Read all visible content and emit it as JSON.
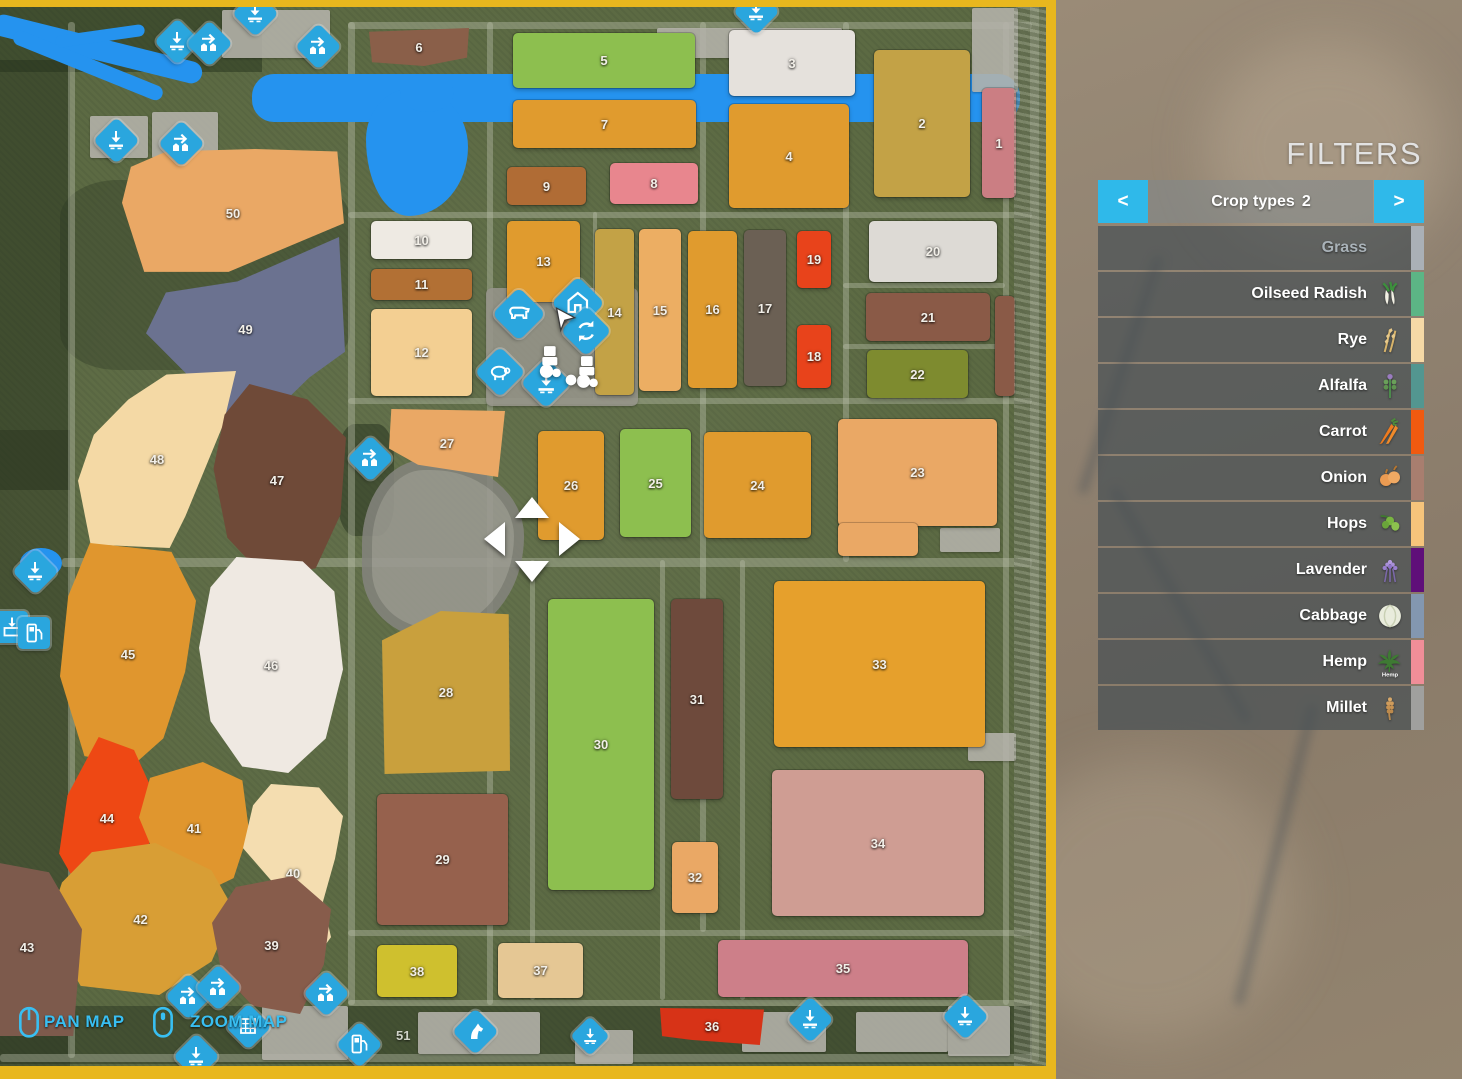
{
  "filters": {
    "title": "FILTERS",
    "header": {
      "label": "Crop types",
      "count": "2",
      "prev": "<",
      "next": ">"
    },
    "items": [
      {
        "label": "Grass",
        "icon": "",
        "color": "#aab0b6",
        "disabled": true
      },
      {
        "label": "Oilseed Radish",
        "icon": "oilseed-radish",
        "color": "#5cb585",
        "disabled": false
      },
      {
        "label": "Rye",
        "icon": "rye",
        "color": "#f6d9a6",
        "disabled": false
      },
      {
        "label": "Alfalfa",
        "icon": "alfalfa",
        "color": "#539690",
        "disabled": false
      },
      {
        "label": "Carrot",
        "icon": "carrot",
        "color": "#f05a10",
        "disabled": false
      },
      {
        "label": "Onion",
        "icon": "onion",
        "color": "#a87e6f",
        "disabled": false
      },
      {
        "label": "Hops",
        "icon": "hops",
        "color": "#f6c47b",
        "disabled": false
      },
      {
        "label": "Lavender",
        "icon": "lavender",
        "color": "#5f0f79",
        "disabled": false
      },
      {
        "label": "Cabbage",
        "icon": "cabbage",
        "color": "#8397b0",
        "disabled": false
      },
      {
        "label": "Hemp",
        "icon": "hemp",
        "color": "#f08e98",
        "disabled": false
      },
      {
        "label": "Millet",
        "icon": "millet",
        "color": "#a0a09e",
        "disabled": false
      }
    ]
  },
  "map": {
    "pan_label": "PAN MAP",
    "zoom_label": "ZOOM MAP",
    "extra_label": "51",
    "fields": [
      {
        "id": "6",
        "x": 369,
        "y": 28,
        "w": 100,
        "h": 38,
        "c": "#8a5f49",
        "poly": "0% 10%,100% 0%,98% 78%,55% 100%,3% 90%"
      },
      {
        "id": "5",
        "x": 513,
        "y": 33,
        "w": 182,
        "h": 55,
        "c": "#8dbf4f"
      },
      {
        "id": "3",
        "x": 729,
        "y": 30,
        "w": 126,
        "h": 66,
        "c": "#e5e1dc"
      },
      {
        "id": "2",
        "x": 874,
        "y": 50,
        "w": 96,
        "h": 147,
        "c": "#c3a246"
      },
      {
        "id": "1",
        "x": 982,
        "y": 88,
        "w": 34,
        "h": 110,
        "c": "#cb7e83"
      },
      {
        "id": "7",
        "x": 513,
        "y": 100,
        "w": 183,
        "h": 48,
        "c": "#e09b2e"
      },
      {
        "id": "4",
        "x": 729,
        "y": 104,
        "w": 120,
        "h": 104,
        "c": "#e09b2e"
      },
      {
        "id": "9",
        "x": 507,
        "y": 167,
        "w": 79,
        "h": 38,
        "c": "#b06c35"
      },
      {
        "id": "8",
        "x": 610,
        "y": 163,
        "w": 88,
        "h": 41,
        "c": "#e8868e"
      },
      {
        "id": "10",
        "x": 371,
        "y": 221,
        "w": 101,
        "h": 38,
        "c": "#eeeae3"
      },
      {
        "id": "11",
        "x": 371,
        "y": 269,
        "w": 101,
        "h": 31,
        "c": "#b27034"
      },
      {
        "id": "13",
        "x": 507,
        "y": 221,
        "w": 73,
        "h": 81,
        "c": "#e09b2e"
      },
      {
        "id": "12",
        "x": 371,
        "y": 309,
        "w": 101,
        "h": 87,
        "c": "#f3cf92"
      },
      {
        "id": "14",
        "x": 595,
        "y": 229,
        "w": 39,
        "h": 166,
        "c": "#c3a246"
      },
      {
        "id": "15",
        "x": 639,
        "y": 229,
        "w": 42,
        "h": 162,
        "c": "#ecae63"
      },
      {
        "id": "16",
        "x": 688,
        "y": 231,
        "w": 49,
        "h": 157,
        "c": "#e09b2e"
      },
      {
        "id": "17",
        "x": 744,
        "y": 230,
        "w": 42,
        "h": 156,
        "c": "#6b6054"
      },
      {
        "id": "19",
        "x": 797,
        "y": 231,
        "w": 34,
        "h": 57,
        "c": "#e8431b"
      },
      {
        "id": "18",
        "x": 797,
        "y": 325,
        "w": 34,
        "h": 63,
        "c": "#e8431b"
      },
      {
        "id": "20",
        "x": 869,
        "y": 221,
        "w": 128,
        "h": 61,
        "c": "#dddad5"
      },
      {
        "id": "21",
        "x": 866,
        "y": 293,
        "w": 124,
        "h": 48,
        "c": "#8a5a47"
      },
      {
        "id": "",
        "x": 995,
        "y": 296,
        "w": 20,
        "h": 100,
        "c": "#8a5a47"
      },
      {
        "id": "22",
        "x": 867,
        "y": 350,
        "w": 101,
        "h": 48,
        "c": "#7e8b2f"
      },
      {
        "id": "27",
        "x": 389,
        "y": 409,
        "w": 116,
        "h": 68,
        "c": "#eaa865",
        "poly": "2% 0%,100% 3%,94% 100%,25% 82%,0% 58%"
      },
      {
        "id": "26",
        "x": 538,
        "y": 431,
        "w": 66,
        "h": 109,
        "c": "#e09b2e"
      },
      {
        "id": "25",
        "x": 620,
        "y": 429,
        "w": 71,
        "h": 108,
        "c": "#8dbf4f"
      },
      {
        "id": "24",
        "x": 704,
        "y": 432,
        "w": 107,
        "h": 106,
        "c": "#e09b2e"
      },
      {
        "id": "23",
        "x": 838,
        "y": 419,
        "w": 159,
        "h": 107,
        "c": "#eaa865"
      },
      {
        "id": "",
        "x": 838,
        "y": 523,
        "w": 80,
        "h": 33,
        "c": "#eaa865"
      },
      {
        "id": "33",
        "x": 774,
        "y": 581,
        "w": 211,
        "h": 166,
        "c": "#e6a02c"
      },
      {
        "id": "34",
        "x": 772,
        "y": 770,
        "w": 212,
        "h": 146,
        "c": "#cf9d93"
      },
      {
        "id": "28",
        "x": 382,
        "y": 611,
        "w": 128,
        "h": 163,
        "c": "#c9a03d",
        "poly": "0% 18%,46% 0%,99% 2%,100% 98%,2% 100%"
      },
      {
        "id": "29",
        "x": 377,
        "y": 794,
        "w": 131,
        "h": 131,
        "c": "#96614d"
      },
      {
        "id": "30",
        "x": 548,
        "y": 599,
        "w": 106,
        "h": 291,
        "c": "#8dbf4f"
      },
      {
        "id": "31",
        "x": 671,
        "y": 599,
        "w": 52,
        "h": 200,
        "c": "#6e4a3c"
      },
      {
        "id": "32",
        "x": 672,
        "y": 842,
        "w": 46,
        "h": 71,
        "c": "#eaa865"
      },
      {
        "id": "38",
        "x": 377,
        "y": 945,
        "w": 80,
        "h": 52,
        "c": "#cfc02e"
      },
      {
        "id": "37",
        "x": 498,
        "y": 943,
        "w": 85,
        "h": 55,
        "c": "#e5c794"
      },
      {
        "id": "35",
        "x": 718,
        "y": 940,
        "w": 250,
        "h": 57,
        "c": "#cd7f89"
      },
      {
        "id": "36",
        "x": 660,
        "y": 1008,
        "w": 104,
        "h": 37,
        "c": "#d73317",
        "poly": "0% 0%,100% 4%,96% 100%,30% 86%,2% 76%"
      },
      {
        "id": "50",
        "x": 122,
        "y": 149,
        "w": 222,
        "h": 128,
        "c": "#eaa865",
        "poly": "4% 14%,20% 2%,60% 0%,97% 2%,100% 58%,78% 74%,48% 96%,10% 96%,0% 42%"
      },
      {
        "id": "49",
        "x": 146,
        "y": 237,
        "w": 199,
        "h": 185,
        "c": "#6b7290",
        "poly": "46% 24%,97% 0%,100% 62%,82% 76%,62% 97%,42% 100%,24% 78%,0% 52%,10% 30%"
      },
      {
        "id": "48",
        "x": 78,
        "y": 371,
        "w": 158,
        "h": 177,
        "c": "#f4d9a5",
        "poly": "56% 2%,100% 0%,92% 30%,80% 56%,68% 82%,58% 100%,8% 98%,0% 62%,10% 36%,32% 16%"
      },
      {
        "id": "47",
        "x": 208,
        "y": 384,
        "w": 138,
        "h": 192,
        "c": "#6f4a38",
        "poly": "30% 0%,72% 8%,100% 28%,96% 68%,78% 96%,40% 100%,14% 80%,4% 44%,12% 16%"
      },
      {
        "id": "45",
        "x": 60,
        "y": 543,
        "w": 136,
        "h": 222,
        "c": "#e0962e",
        "poly": "22% 0%,82% 4%,100% 26%,92% 58%,76% 88%,54% 100%,18% 96%,0% 60%,6% 24%"
      },
      {
        "id": "46",
        "x": 199,
        "y": 557,
        "w": 144,
        "h": 216,
        "c": "#efe9e2",
        "poly": "26% 0%,72% 2%,94% 16%,100% 52%,88% 84%,62% 100%,30% 97%,8% 76%,0% 42%,8% 14%"
      },
      {
        "id": "44",
        "x": 55,
        "y": 737,
        "w": 104,
        "h": 162,
        "c": "#ee4814",
        "poly": "42% 0%,76% 8%,100% 42%,88% 72%,62% 100%,26% 97%,4% 72%,12% 36%"
      },
      {
        "id": "41",
        "x": 139,
        "y": 762,
        "w": 110,
        "h": 132,
        "c": "#e0962e",
        "poly": "10% 12%,58% 0%,94% 14%,100% 52%,86% 88%,56% 100%,20% 82%,0% 42%"
      },
      {
        "id": "40",
        "x": 243,
        "y": 784,
        "w": 100,
        "h": 178,
        "c": "#f4ddb0",
        "poly": "28% 0%,76% 2%,100% 18%,92% 42%,80% 66%,88% 86%,70% 100%,48% 86%,34% 58%,0% 36%,10% 12%"
      },
      {
        "id": "42",
        "x": 47,
        "y": 843,
        "w": 187,
        "h": 152,
        "c": "#d89e35",
        "poly": "24% 6%,58% 0%,88% 18%,100% 44%,88% 78%,60% 100%,18% 94%,0% 56%,8% 26%"
      },
      {
        "id": "39",
        "x": 212,
        "y": 876,
        "w": 119,
        "h": 138,
        "c": "#875c4b",
        "poly": "20% 8%,68% 0%,100% 24%,94% 64%,74% 100%,34% 94%,8% 70%,0% 34%"
      },
      {
        "id": "43",
        "x": -28,
        "y": 858,
        "w": 110,
        "h": 178,
        "c": "#7d5a4c",
        "poly": "0% 0%,70% 8%,100% 40%,92% 100%,0% 100%"
      }
    ],
    "pois": [
      {
        "t": "download",
        "x": 255,
        "y": 13
      },
      {
        "t": "download",
        "x": 177,
        "y": 41
      },
      {
        "t": "sell",
        "x": 209,
        "y": 43
      },
      {
        "t": "sell",
        "x": 318,
        "y": 46
      },
      {
        "t": "download",
        "x": 756,
        "y": 11
      },
      {
        "t": "download",
        "x": 116,
        "y": 140
      },
      {
        "t": "sell",
        "x": 181,
        "y": 143
      },
      {
        "t": "sell",
        "x": 370,
        "y": 458
      },
      {
        "t": "cow",
        "x": 519,
        "y": 314,
        "s": 46
      },
      {
        "t": "house",
        "x": 578,
        "y": 303,
        "s": 46
      },
      {
        "t": "loop",
        "x": 586,
        "y": 331,
        "s": 44
      },
      {
        "t": "sheep",
        "x": 500,
        "y": 372,
        "s": 44
      },
      {
        "t": "download",
        "x": 546,
        "y": 383,
        "s": 44
      },
      {
        "t": "download",
        "x": 35,
        "y": 571
      },
      {
        "t": "container",
        "x": 12,
        "y": 627,
        "v": "square"
      },
      {
        "t": "fuel",
        "x": 34,
        "y": 633,
        "v": "square"
      },
      {
        "t": "sell",
        "x": 188,
        "y": 996
      },
      {
        "t": "sell",
        "x": 218,
        "y": 987
      },
      {
        "t": "sell",
        "x": 326,
        "y": 993
      },
      {
        "t": "grid",
        "x": 248,
        "y": 1026
      },
      {
        "t": "fuel",
        "x": 359,
        "y": 1044
      },
      {
        "t": "horse",
        "x": 475,
        "y": 1031
      },
      {
        "t": "download",
        "x": 590,
        "y": 1036,
        "s": 34
      },
      {
        "t": "download",
        "x": 810,
        "y": 1019
      },
      {
        "t": "download",
        "x": 965,
        "y": 1016
      },
      {
        "t": "download",
        "x": 196,
        "y": 1056
      },
      {
        "t": "pointer",
        "x": 566,
        "y": 320,
        "v": "plain",
        "s": 30
      },
      {
        "t": "tractor",
        "x": 549,
        "y": 362,
        "v": "plain",
        "s": 40
      },
      {
        "t": "tractor",
        "x": 586,
        "y": 372,
        "v": "plain",
        "s": 40
      },
      {
        "t": "dot",
        "x": 571,
        "y": 380,
        "v": "plain",
        "s": 16
      }
    ]
  }
}
